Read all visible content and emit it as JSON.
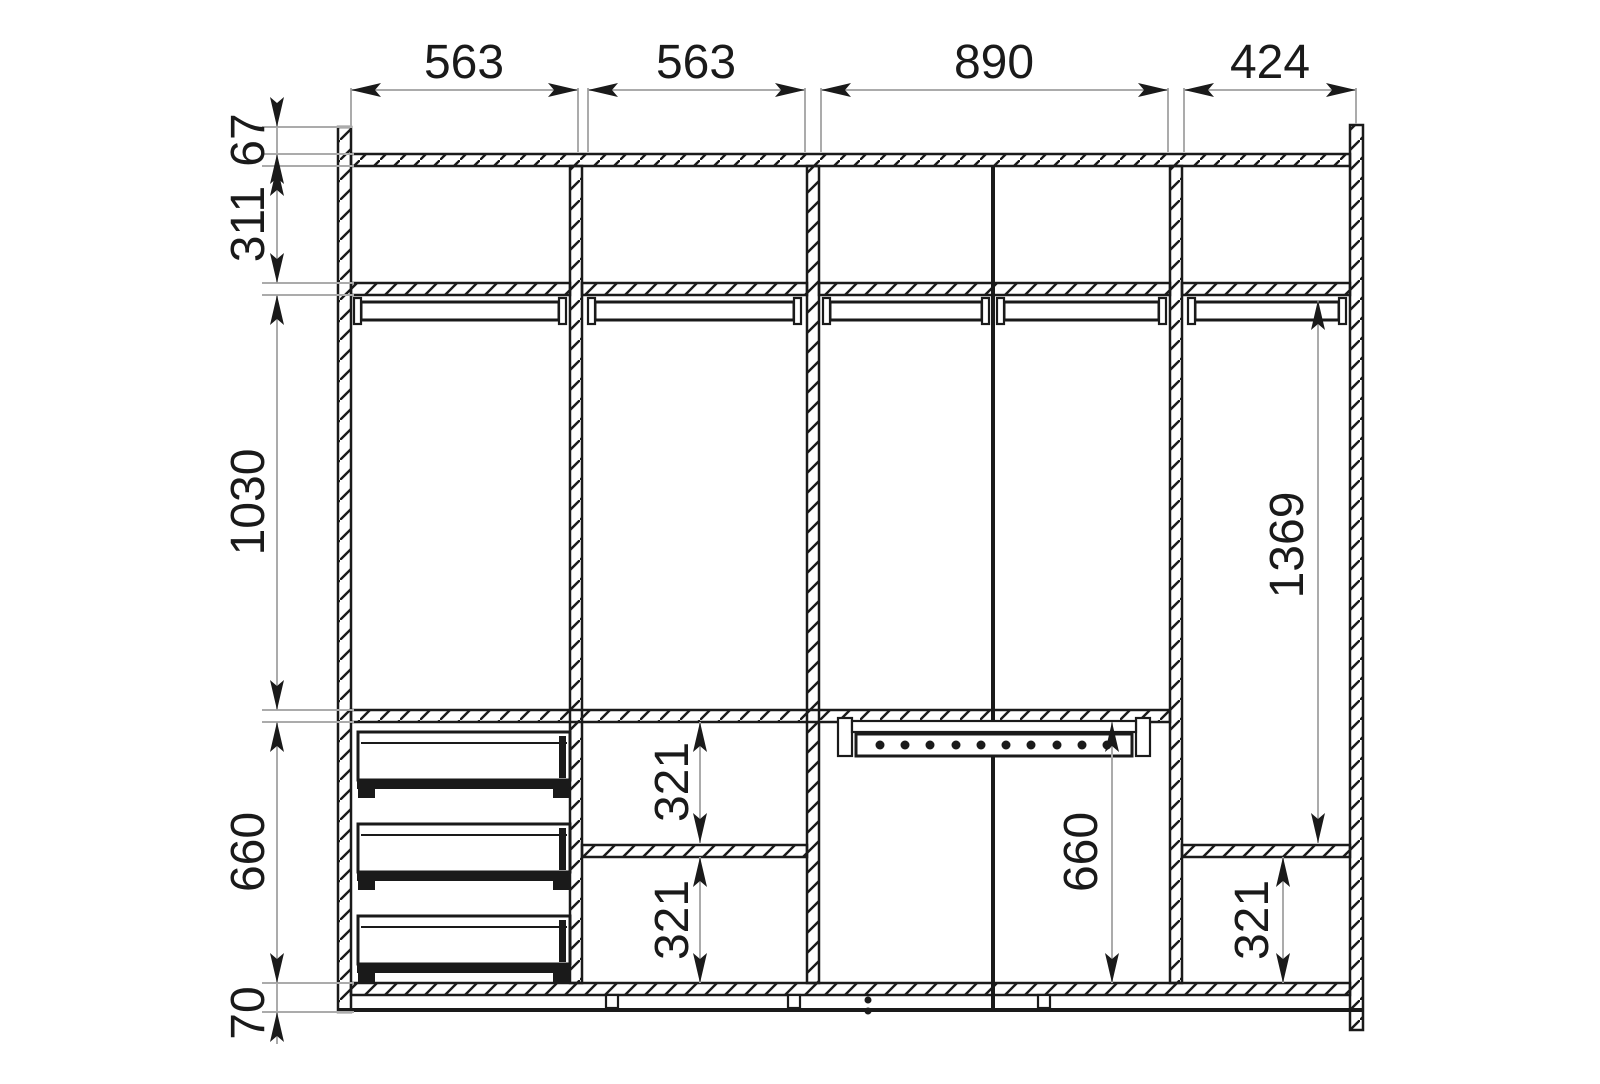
{
  "dimensions": {
    "top_widths": [
      "563",
      "563",
      "890",
      "424"
    ],
    "left_heights": [
      "67",
      "311",
      "1030",
      "660",
      "70"
    ],
    "interior": {
      "col2_upper_height": "321",
      "col2_lower_height": "321",
      "col3_lower_height": "660",
      "col4_tall_height": "1369",
      "col4_lower_height": "321"
    }
  },
  "colors": {
    "structure_line": "#1a1a1a",
    "dimension_line": "#ababab",
    "background": "#ffffff",
    "text": "#1a1a1a"
  }
}
